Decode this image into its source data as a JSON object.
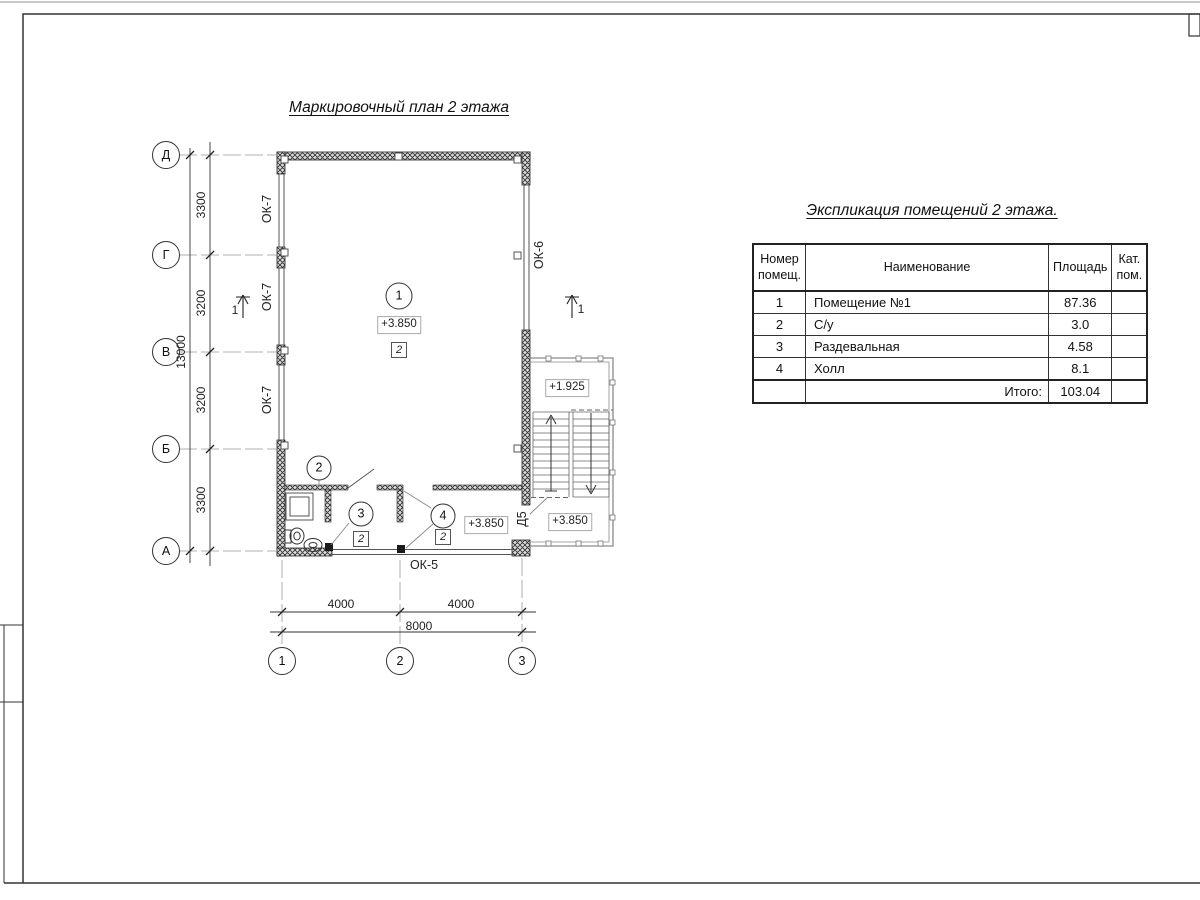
{
  "titles": {
    "plan": "Маркировочный план 2 этажа",
    "schedule": "Экспликация помещений 2 этажа."
  },
  "axes": {
    "v": [
      "Д",
      "Г",
      "В",
      "Б",
      "А"
    ],
    "h": [
      "1",
      "2",
      "3"
    ]
  },
  "dims": {
    "left_chain": [
      "3300",
      "3200",
      "3200",
      "3300"
    ],
    "left_total": "13000",
    "bottom_chain": [
      "4000",
      "4000"
    ],
    "bottom_total": "8000"
  },
  "labels": {
    "window_left": "ОК-7",
    "window_right": "ОК-6",
    "window_bottom": "ОК-5",
    "door": "Д5",
    "section_mark": "1",
    "finish_mark": "2"
  },
  "rooms": {
    "marks": [
      "1",
      "2",
      "3",
      "4"
    ],
    "elev_main": "+3.850",
    "elev_hall": "+3.850",
    "elev_stair_mid": "+1.925",
    "elev_stair_bottom": "+3.850"
  },
  "schedule": {
    "col_num": "Номер\nпомещ.",
    "col_name": "Наименование",
    "col_area": "Площадь",
    "col_cat": "Кат.\nпом.",
    "rows": [
      {
        "num": "1",
        "name": "Помещение №1",
        "area": "87.36",
        "cat": ""
      },
      {
        "num": "2",
        "name": "С/у",
        "area": "3.0",
        "cat": ""
      },
      {
        "num": "3",
        "name": "Раздевальная",
        "area": "4.58",
        "cat": ""
      },
      {
        "num": "4",
        "name": "Холл",
        "area": "8.1",
        "cat": ""
      }
    ],
    "total_label": "Итого:",
    "total_value": "103.04"
  },
  "colors": {
    "line": "#222222",
    "thin": "#888888",
    "hatch": "#333333"
  }
}
